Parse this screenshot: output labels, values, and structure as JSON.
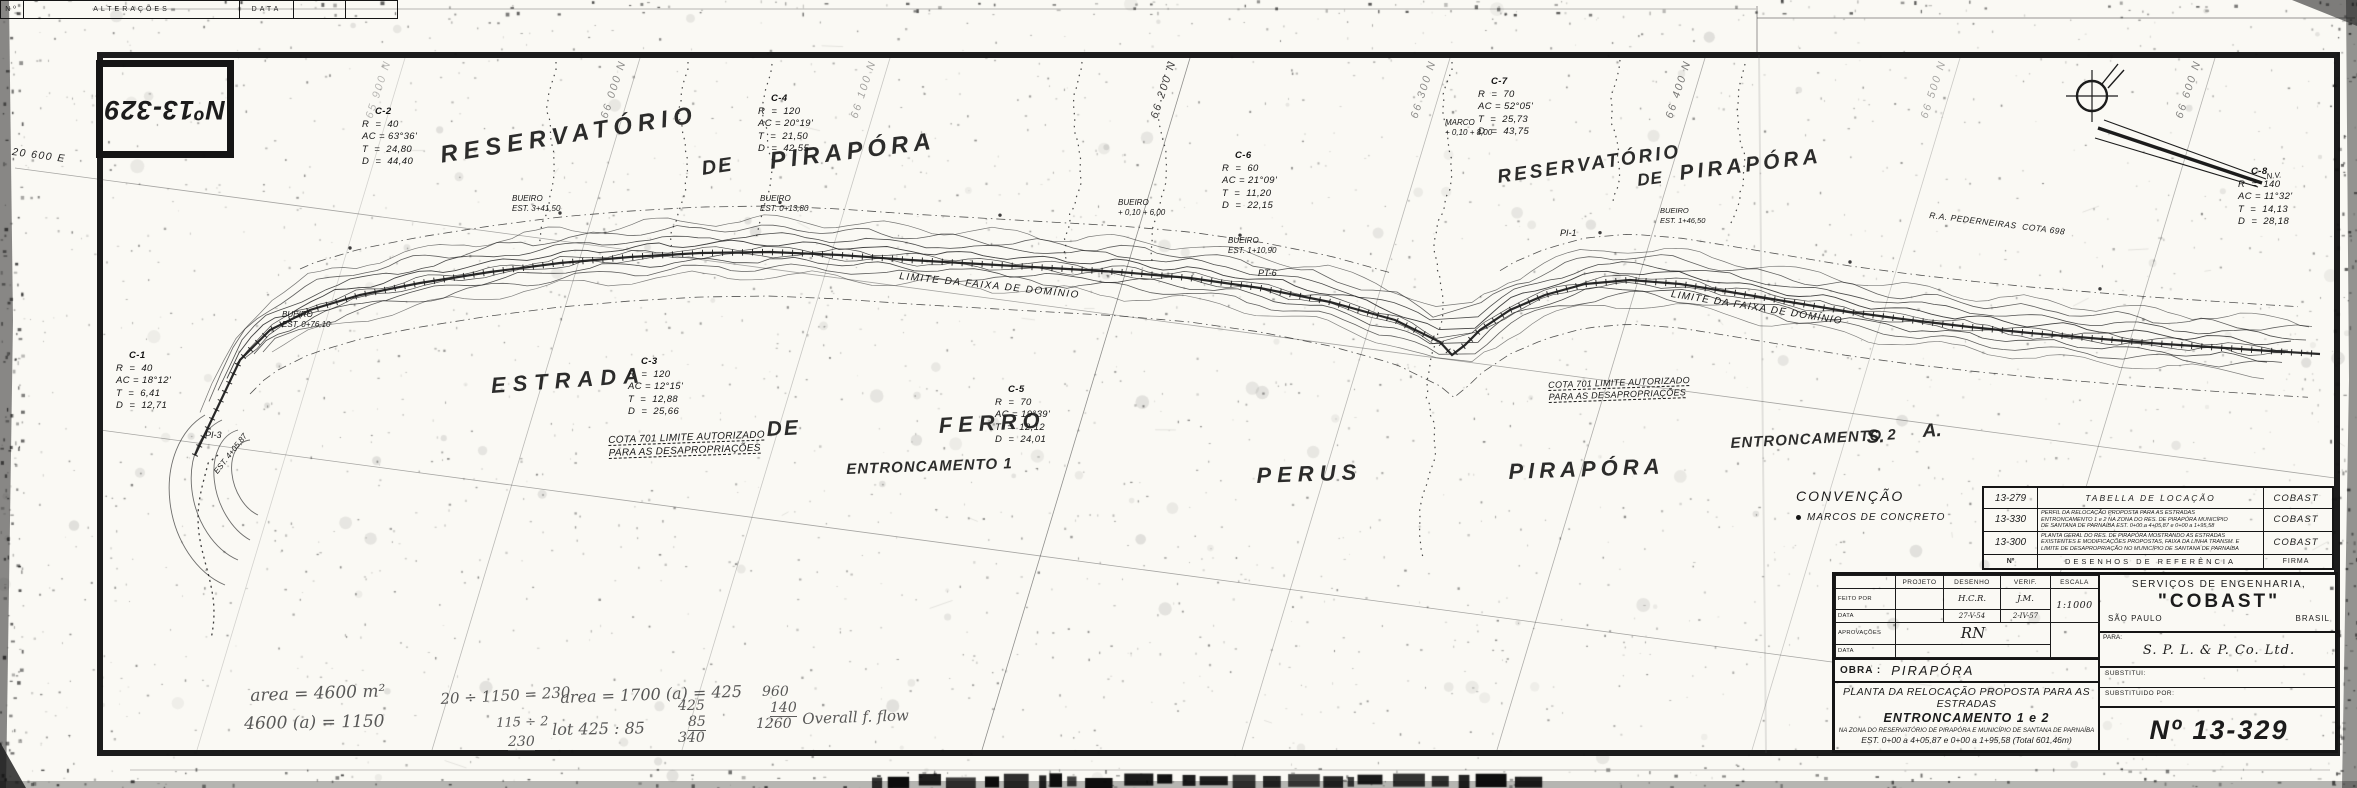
{
  "colors": {
    "ink": "#1c1c1c",
    "paper": "#faf9f4",
    "pencil": "#4a4a4a"
  },
  "corner_stamp": {
    "text": "Nº13-329"
  },
  "legend": {
    "title": "CONVENÇÃO",
    "item": "MARCOS DE CONCRETO"
  },
  "grid": {
    "n_lines": [
      {
        "x": 405,
        "label": "65 900 N",
        "op": 0.3
      },
      {
        "x": 640,
        "label": "66 000 N",
        "op": 0.5
      },
      {
        "x": 890,
        "label": "66 100 N",
        "op": 0.4
      },
      {
        "x": 1190,
        "label": "66 200 N",
        "op": 0.85
      },
      {
        "x": 1450,
        "label": "66 300 N",
        "op": 0.5
      },
      {
        "x": 1705,
        "label": "66 400 N",
        "op": 0.6
      },
      {
        "x": 1960,
        "label": "66 500 N",
        "op": 0.38
      },
      {
        "x": 2215,
        "label": "66 600 N",
        "op": 0.55
      }
    ],
    "e_lines": [
      {
        "x1": 15,
        "y1": 168,
        "x2": 2335,
        "y2": 478,
        "label": "20 600 E",
        "lx": 13,
        "ly": 146,
        "rot": 7.6
      },
      {
        "x1": 100,
        "y1": 430,
        "x2": 1832,
        "y2": 662,
        "label": "",
        "lx": 0,
        "ly": 0,
        "rot": 0
      }
    ]
  },
  "curve_tables": [
    {
      "id": "C-2",
      "x": 362,
      "y": 106,
      "lines": [
        "R  =  40",
        "AC = 63°36'",
        "T  =  24,80",
        "D  =  44,40"
      ]
    },
    {
      "id": "C-4",
      "x": 758,
      "y": 93,
      "lines": [
        "R  =  120",
        "AC = 20°19'",
        "T  =  21,50",
        "D  =  42,55"
      ]
    },
    {
      "id": "C-6",
      "x": 1222,
      "y": 150,
      "lines": [
        "R  =  60",
        "AC = 21°09'",
        "T  =  11,20",
        "D  =  22,15"
      ]
    },
    {
      "id": "C-7",
      "x": 1478,
      "y": 76,
      "lines": [
        "R  =  70",
        "AC = 52°05'",
        "T  =  25,73",
        "D  =  43,75"
      ]
    },
    {
      "id": "C-3",
      "x": 628,
      "y": 356,
      "lines": [
        "R  =  120",
        "AC = 12°15'",
        "T  =  12,88",
        "D  =  25,66"
      ]
    },
    {
      "id": "C-5",
      "x": 995,
      "y": 384,
      "lines": [
        "R  =  70",
        "AC = 19°39'",
        "T  =  12,12",
        "D  =  24,01"
      ]
    },
    {
      "id": "C-1",
      "x": 116,
      "y": 350,
      "lines": [
        "R  =  40",
        "AC = 18°12'",
        "T  =  6,41",
        "D  =  12,71"
      ]
    },
    {
      "id": "C-8",
      "x": 2238,
      "y": 166,
      "lines": [
        "R  =  140",
        "AC = 11°32'",
        "T  =  14,13",
        "D  =  28,18"
      ]
    }
  ],
  "map_labels": [
    {
      "t": "RESERVATÓRIO",
      "x": 438,
      "y": 140,
      "s": 24,
      "r": -9,
      "ls": 6,
      "big": true
    },
    {
      "t": "DE",
      "x": 700,
      "y": 156,
      "s": 20,
      "r": -8,
      "ls": 2,
      "big": true
    },
    {
      "t": "PIRAPÓRA",
      "x": 768,
      "y": 146,
      "s": 24,
      "r": -7,
      "ls": 5,
      "big": true
    },
    {
      "t": "RESERVATÓRIO",
      "x": 1496,
      "y": 166,
      "s": 19,
      "r": -8,
      "ls": 3,
      "big": true
    },
    {
      "t": "DE",
      "x": 1636,
      "y": 170,
      "s": 17,
      "r": -7,
      "ls": 1,
      "big": true
    },
    {
      "t": "PIRAPÓRA",
      "x": 1678,
      "y": 160,
      "s": 21,
      "r": -7,
      "ls": 4,
      "big": true
    },
    {
      "t": "ESTRADA",
      "x": 490,
      "y": 372,
      "s": 22,
      "r": -4,
      "ls": 7,
      "big": true
    },
    {
      "t": "DE",
      "x": 766,
      "y": 416,
      "s": 21,
      "r": -3,
      "ls": 2,
      "big": true
    },
    {
      "t": "FERRO",
      "x": 938,
      "y": 412,
      "s": 22,
      "r": -3,
      "ls": 6,
      "big": true
    },
    {
      "t": "PERUS",
      "x": 1256,
      "y": 462,
      "s": 22,
      "r": -2,
      "ls": 6,
      "big": true
    },
    {
      "t": "PIRAPÓRA",
      "x": 1508,
      "y": 458,
      "s": 22,
      "r": -2,
      "ls": 5,
      "big": true
    },
    {
      "t": "S.",
      "x": 1866,
      "y": 426,
      "s": 19,
      "r": -3,
      "ls": 0,
      "big": true
    },
    {
      "t": "A.",
      "x": 1922,
      "y": 420,
      "s": 19,
      "r": -3,
      "ls": 0,
      "big": true
    },
    {
      "t": "ENTRONCAMENTO 1",
      "x": 846,
      "y": 460,
      "s": 15,
      "r": -2,
      "ls": 1,
      "big": true
    },
    {
      "t": "ENTRONCAMENTO 2",
      "x": 1730,
      "y": 434,
      "s": 15,
      "r": -3,
      "ls": 1,
      "big": true
    },
    {
      "t": "COTA 701 LIMITE AUTORIZADO\nPARA AS DESAPROPRIAÇÕES",
      "x": 608,
      "y": 434,
      "s": 10,
      "r": -2,
      "ls": 0.3,
      "dash": true
    },
    {
      "t": "COTA 701 LIMITE AUTORIZADO\nPARA AS DESAPROPRIAÇÕES",
      "x": 1548,
      "y": 380,
      "s": 9,
      "r": -2,
      "ls": 0.3,
      "dash": true
    },
    {
      "t": "LIMITE DA FAIXA DE DOMÍNIO",
      "x": 900,
      "y": 270,
      "s": 10,
      "r": 6,
      "ls": 1.5
    },
    {
      "t": "LIMITE DA FAIXA DE DOMÍNIO",
      "x": 1672,
      "y": 288,
      "s": 10,
      "r": 9,
      "ls": 1.2
    },
    {
      "t": "R.A. PEDERNEIRAS  COTA 698",
      "x": 1930,
      "y": 210,
      "s": 8.5,
      "r": 7,
      "ls": 0.5
    },
    {
      "t": "BUEIRO\nEST. 0+76,10",
      "x": 282,
      "y": 310,
      "s": 8,
      "r": 0,
      "ls": 0
    },
    {
      "t": "BUEIRO\nEST. 3+41,50",
      "x": 512,
      "y": 194,
      "s": 8,
      "r": 0,
      "ls": 0
    },
    {
      "t": "BUEIRO\nEST. 0+13,80",
      "x": 760,
      "y": 194,
      "s": 8,
      "r": 0,
      "ls": 0
    },
    {
      "t": "BUEIRO\n+ 0,10 + 6,00",
      "x": 1118,
      "y": 198,
      "s": 8,
      "r": 0,
      "ls": 0
    },
    {
      "t": "BUEIRO\nEST. 1+10,90",
      "x": 1228,
      "y": 236,
      "s": 8,
      "r": 0,
      "ls": 0
    },
    {
      "t": "MARCO\n+ 0,10 + 8,00",
      "x": 1445,
      "y": 118,
      "s": 8,
      "r": 0,
      "ls": 0
    },
    {
      "t": "BUEIRO\nEST. 1+46,50",
      "x": 1660,
      "y": 206,
      "s": 7.5,
      "r": 0,
      "ls": 0
    },
    {
      "t": "PT-6",
      "x": 1258,
      "y": 268,
      "s": 9,
      "r": 0,
      "ls": 0
    },
    {
      "t": "PI-1",
      "x": 1560,
      "y": 228,
      "s": 9,
      "r": 0,
      "ls": 0
    },
    {
      "t": "PI-3",
      "x": 205,
      "y": 430,
      "s": 9,
      "r": 0,
      "ls": 0
    },
    {
      "t": "EST. 4+05,87",
      "x": 212,
      "y": 470,
      "s": 8,
      "r": -52,
      "ls": 0
    },
    {
      "t": "N.V.",
      "x": 2266,
      "y": 172,
      "s": 8,
      "r": -6,
      "ls": 0
    }
  ],
  "ref_table": {
    "rows": [
      {
        "num": "13-279",
        "desc": [
          "TABELLA DE LOCAÇÃO"
        ],
        "firm": "COBAST"
      },
      {
        "num": "13-330",
        "desc": [
          "PERFIL DA RELOCAÇÃO PROPOSTA PARA AS ESTRADAS",
          "ENTRONCAMENTO 1 e 2 NA ZONA DO RES. DE PIRAPÓRA MUNICÍPIO",
          "DE SANTANA DE PARNAÍBA EST. 0+00 a 4+05,87 e 0+00 a 1+95,58"
        ],
        "firm": "COBAST"
      },
      {
        "num": "13-300",
        "desc": [
          "PLANTA GERAL DO RES. DE PIRAPÓRA MOSTRANDO AS ESTRADAS",
          "EXISTENTES E MODIFICAÇÕES PROPOSTAS, FAIXA DA LINHA TRANSM. E",
          "LIMITE DE DESAPROPRIAÇÃO NO MUNICÍPIO DE SANTANA DE PARNAÍBA"
        ],
        "firm": "COBAST"
      }
    ],
    "footer": {
      "num": "Nº",
      "desc": "DESENHOS DE REFERÊNCIA",
      "firm": "FIRMA"
    }
  },
  "title_block": {
    "personnel": {
      "col_projeto": "PROJETO",
      "col_desenho": "DESENHO",
      "col_verif": "VERIF.",
      "escala_label": "ESCALA",
      "escala_value": "1:1000",
      "row_feito": "FEITO POR",
      "row_data1": "DATA",
      "row_aprov": "APROVAÇÕES",
      "row_data2": "DATA",
      "desenho_by": "H.C.R.",
      "desenho_date": "27-V-54",
      "verif_by": "J.M.",
      "verif_date": "2-IV-57",
      "aprov_sig": "RN"
    },
    "company_line1": "SERVIÇOS DE ENGENHARIA,",
    "company_name": "\"COBAST\"",
    "company_city": "SÃO PAULO",
    "company_country": "BRASIL",
    "para_label": "PARA:",
    "para_value": "S. P. L. & P. Co. Ltd.",
    "obra_label": "OBRA :",
    "obra_value": "PIRAPÓRA",
    "title_line1": "PLANTA DA RELOCAÇÃO PROPOSTA PARA AS",
    "title_line2": "ESTRADAS",
    "title_line3": "ENTRONCAMENTO 1 e 2",
    "title_sub1": "NA ZONA DO RESERVATÓRIO DE PIRAPÓRA E MUNICÍPIO DE SANTANA DE PARNAÍBA",
    "title_sub2": "EST. 0+00 a 4+05,87 e 0+00 a 1+95,58 (Total 601,46m)",
    "substitui_label": "SUBSTITUI:",
    "substituido_label": "SUBSTITUIDO POR:",
    "number": "Nº 13-329"
  },
  "alterations": {
    "cells": [
      "Nº",
      "ALTERAÇÕES",
      "DATA",
      "",
      ""
    ]
  },
  "notes": [
    {
      "t": "area = 4600 m²",
      "x": 250,
      "y": 686,
      "s": 17,
      "r": -2
    },
    {
      "t": "4600 (a) = 1150",
      "x": 244,
      "y": 714,
      "s": 17,
      "r": -1
    },
    {
      "t": "20 ÷ 1150 = 230",
      "x": 440,
      "y": 690,
      "s": 15,
      "r": -3
    },
    {
      "t": "115 ÷ 2",
      "x": 496,
      "y": 716,
      "s": 13,
      "r": -2
    },
    {
      "t": "230",
      "x": 508,
      "y": 734,
      "s": 14,
      "r": 0,
      "ul": true
    },
    {
      "t": "area = 1700 (a) = 425",
      "x": 560,
      "y": 688,
      "s": 16,
      "r": -2
    },
    {
      "t": "lot 425 : 85",
      "x": 552,
      "y": 720,
      "s": 16,
      "r": -1
    },
    {
      "t": "425",
      "x": 678,
      "y": 698,
      "s": 14,
      "r": 0
    },
    {
      "t": "85",
      "x": 688,
      "y": 714,
      "s": 14,
      "r": 0,
      "ul": true
    },
    {
      "t": "340",
      "x": 678,
      "y": 730,
      "s": 14,
      "r": 0
    },
    {
      "t": "960",
      "x": 762,
      "y": 684,
      "s": 14,
      "r": 0
    },
    {
      "t": "140",
      "x": 770,
      "y": 700,
      "s": 14,
      "r": 0,
      "ul": true
    },
    {
      "t": "1260",
      "x": 756,
      "y": 716,
      "s": 14,
      "r": 0
    },
    {
      "t": "Overall f. flow",
      "x": 802,
      "y": 710,
      "s": 15,
      "r": -2
    }
  ]
}
